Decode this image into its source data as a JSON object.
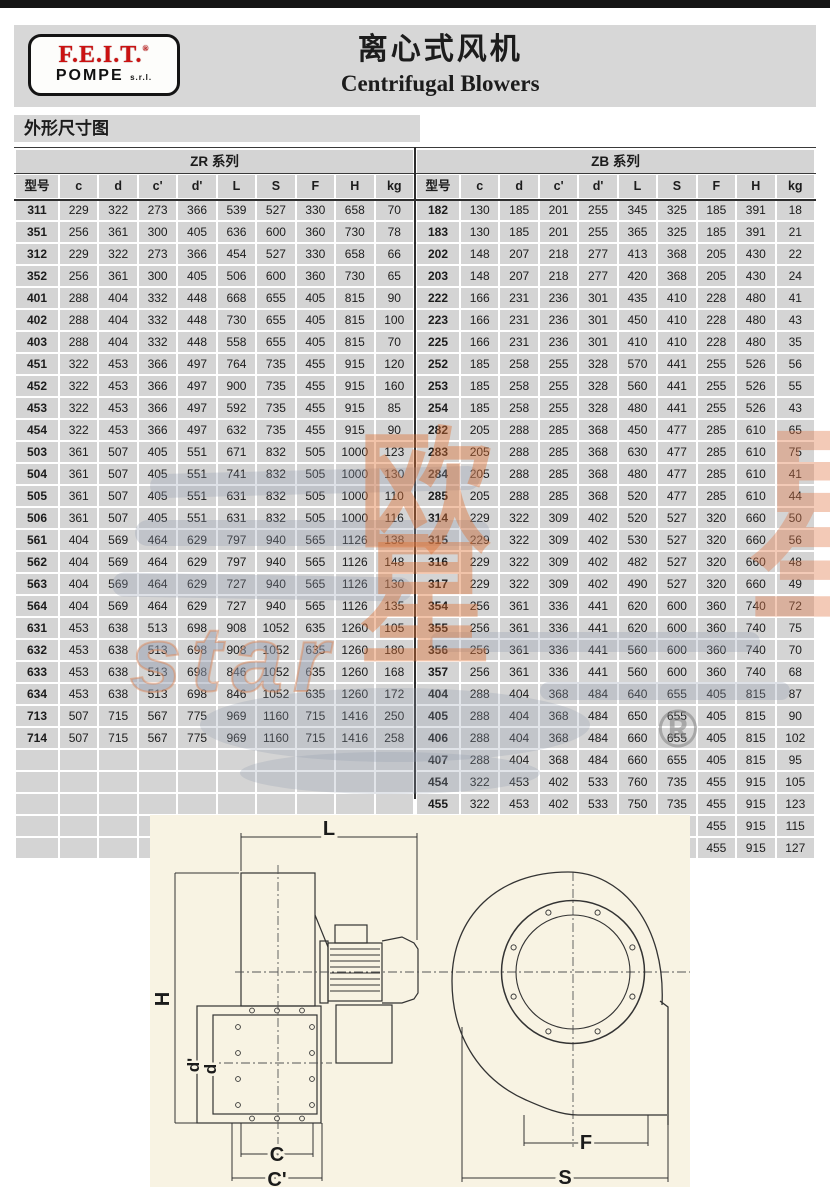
{
  "header": {
    "logo": {
      "brand": "F.E.I.T.",
      "reg": "®",
      "sub": "POMPE",
      "suffix": "s.r.l."
    },
    "title_cn": "离心式风机",
    "title_en": "Centrifugal Blowers"
  },
  "section": {
    "title": "外形尺寸图"
  },
  "table": {
    "series_left": "ZR 系列",
    "series_right": "ZB 系列",
    "columns": [
      "型号",
      "c",
      "d",
      "c'",
      "d'",
      "L",
      "S",
      "F",
      "H",
      "kg"
    ],
    "zr_rows": [
      [
        "311",
        229,
        322,
        273,
        366,
        539,
        527,
        330,
        658,
        70
      ],
      [
        "351",
        256,
        361,
        300,
        405,
        636,
        600,
        360,
        730,
        78
      ],
      [
        "312",
        229,
        322,
        273,
        366,
        454,
        527,
        330,
        658,
        66
      ],
      [
        "352",
        256,
        361,
        300,
        405,
        506,
        600,
        360,
        730,
        65
      ],
      [
        "401",
        288,
        404,
        332,
        448,
        668,
        655,
        405,
        815,
        90
      ],
      [
        "402",
        288,
        404,
        332,
        448,
        730,
        655,
        405,
        815,
        100
      ],
      [
        "403",
        288,
        404,
        332,
        448,
        558,
        655,
        405,
        815,
        70
      ],
      [
        "451",
        322,
        453,
        366,
        497,
        764,
        735,
        455,
        915,
        120
      ],
      [
        "452",
        322,
        453,
        366,
        497,
        900,
        735,
        455,
        915,
        160
      ],
      [
        "453",
        322,
        453,
        366,
        497,
        592,
        735,
        455,
        915,
        85
      ],
      [
        "454",
        322,
        453,
        366,
        497,
        632,
        735,
        455,
        915,
        90
      ],
      [
        "503",
        361,
        507,
        405,
        551,
        671,
        832,
        505,
        1000,
        123
      ],
      [
        "504",
        361,
        507,
        405,
        551,
        741,
        832,
        505,
        1000,
        130
      ],
      [
        "505",
        361,
        507,
        405,
        551,
        631,
        832,
        505,
        1000,
        110
      ],
      [
        "506",
        361,
        507,
        405,
        551,
        631,
        832,
        505,
        1000,
        116
      ],
      [
        "561",
        404,
        569,
        464,
        629,
        797,
        940,
        565,
        1126,
        138
      ],
      [
        "562",
        404,
        569,
        464,
        629,
        797,
        940,
        565,
        1126,
        148
      ],
      [
        "563",
        404,
        569,
        464,
        629,
        727,
        940,
        565,
        1126,
        130
      ],
      [
        "564",
        404,
        569,
        464,
        629,
        727,
        940,
        565,
        1126,
        135
      ],
      [
        "631",
        453,
        638,
        513,
        698,
        908,
        1052,
        635,
        1260,
        105
      ],
      [
        "632",
        453,
        638,
        513,
        698,
        908,
        1052,
        635,
        1260,
        180
      ],
      [
        "633",
        453,
        638,
        513,
        698,
        846,
        1052,
        635,
        1260,
        168
      ],
      [
        "634",
        453,
        638,
        513,
        698,
        846,
        1052,
        635,
        1260,
        172
      ],
      [
        "713",
        507,
        715,
        567,
        775,
        969,
        1160,
        715,
        1416,
        250
      ],
      [
        "714",
        507,
        715,
        567,
        775,
        969,
        1160,
        715,
        1416,
        258
      ],
      [
        "",
        "",
        "",
        "",
        "",
        "",
        "",
        "",
        "",
        ""
      ],
      [
        "",
        "",
        "",
        "",
        "",
        "",
        "",
        "",
        "",
        ""
      ],
      [
        "",
        "",
        "",
        "",
        "",
        "",
        "",
        "",
        "",
        ""
      ],
      [
        "",
        "",
        "",
        "",
        "",
        "",
        "",
        "",
        "",
        ""
      ],
      [
        "",
        "",
        "",
        "",
        "",
        "",
        "",
        "",
        "",
        ""
      ]
    ],
    "zb_rows": [
      [
        "182",
        130,
        185,
        201,
        255,
        345,
        325,
        185,
        391,
        18
      ],
      [
        "183",
        130,
        185,
        201,
        255,
        365,
        325,
        185,
        391,
        21
      ],
      [
        "202",
        148,
        207,
        218,
        277,
        413,
        368,
        205,
        430,
        22
      ],
      [
        "203",
        148,
        207,
        218,
        277,
        420,
        368,
        205,
        430,
        24
      ],
      [
        "222",
        166,
        231,
        236,
        301,
        435,
        410,
        228,
        480,
        41
      ],
      [
        "223",
        166,
        231,
        236,
        301,
        450,
        410,
        228,
        480,
        43
      ],
      [
        "225",
        166,
        231,
        236,
        301,
        410,
        410,
        228,
        480,
        35
      ],
      [
        "252",
        185,
        258,
        255,
        328,
        570,
        441,
        255,
        526,
        56
      ],
      [
        "253",
        185,
        258,
        255,
        328,
        560,
        441,
        255,
        526,
        55
      ],
      [
        "254",
        185,
        258,
        255,
        328,
        480,
        441,
        255,
        526,
        43
      ],
      [
        "282",
        205,
        288,
        285,
        368,
        450,
        477,
        285,
        610,
        65
      ],
      [
        "283",
        205,
        288,
        285,
        368,
        630,
        477,
        285,
        610,
        75
      ],
      [
        "284",
        205,
        288,
        285,
        368,
        480,
        477,
        285,
        610,
        41
      ],
      [
        "285",
        205,
        288,
        285,
        368,
        520,
        477,
        285,
        610,
        44
      ],
      [
        "314",
        229,
        322,
        309,
        402,
        520,
        527,
        320,
        660,
        50
      ],
      [
        "315",
        229,
        322,
        309,
        402,
        530,
        527,
        320,
        660,
        56
      ],
      [
        "316",
        229,
        322,
        309,
        402,
        482,
        527,
        320,
        660,
        48
      ],
      [
        "317",
        229,
        322,
        309,
        402,
        490,
        527,
        320,
        660,
        49
      ],
      [
        "354",
        256,
        361,
        336,
        441,
        620,
        600,
        360,
        740,
        72
      ],
      [
        "355",
        256,
        361,
        336,
        441,
        620,
        600,
        360,
        740,
        75
      ],
      [
        "356",
        256,
        361,
        336,
        441,
        560,
        600,
        360,
        740,
        70
      ],
      [
        "357",
        256,
        361,
        336,
        441,
        560,
        600,
        360,
        740,
        68
      ],
      [
        "404",
        288,
        404,
        368,
        484,
        640,
        655,
        405,
        815,
        87
      ],
      [
        "405",
        288,
        404,
        368,
        484,
        650,
        655,
        405,
        815,
        90
      ],
      [
        "406",
        288,
        404,
        368,
        484,
        660,
        655,
        405,
        815,
        102
      ],
      [
        "407",
        288,
        404,
        368,
        484,
        660,
        655,
        405,
        815,
        95
      ],
      [
        "454",
        322,
        453,
        402,
        533,
        760,
        735,
        455,
        915,
        105
      ],
      [
        "455",
        322,
        453,
        402,
        533,
        750,
        735,
        455,
        915,
        123
      ],
      [
        "456",
        322,
        453,
        402,
        533,
        750,
        735,
        455,
        915,
        115
      ],
      [
        "457",
        322,
        453,
        402,
        533,
        750,
        735,
        455,
        915,
        127
      ]
    ]
  },
  "watermark": {
    "cn": "欧星",
    "cn_right": "星",
    "latin": "star",
    "reg": "®"
  },
  "drawing": {
    "labels": {
      "L": "L",
      "H": "H",
      "d_prime": "d'",
      "d": "d",
      "C": "C",
      "C_prime": "C'",
      "F": "F",
      "S": "S"
    }
  },
  "colors": {
    "band_gray": "#d7d7d7",
    "cell_gray": "#d4d4d4",
    "brand_red": "#cb1212",
    "drawing_bg": "#f8f3e3",
    "watermark_orange": "#dd6f33",
    "watermark_gray": "#939db0"
  }
}
